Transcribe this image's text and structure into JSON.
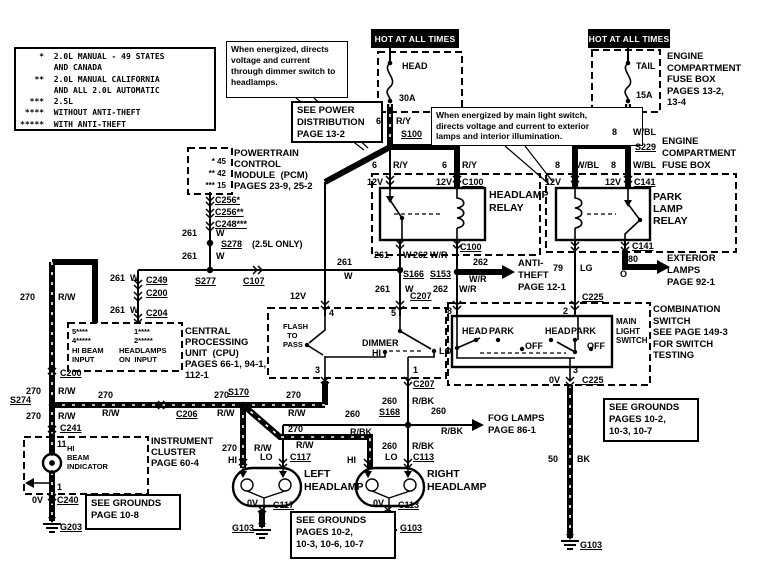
{
  "diagram": {
    "width": 775,
    "height": 571,
    "ink": "#000000",
    "paper": "#ffffff"
  },
  "bars": [
    {
      "name": "hot-at-all-times-left",
      "text": "HOT AT ALL TIMES",
      "x": 371,
      "y": 29,
      "w": 88,
      "h": 19
    },
    {
      "name": "hot-at-all-times-right",
      "text": "HOT AT ALL TIMES",
      "x": 588,
      "y": 29,
      "w": 82,
      "h": 19
    }
  ],
  "boxes": [
    {
      "name": "legend-box",
      "x": 14,
      "y": 47,
      "w": 202,
      "h": 84,
      "s": 8,
      "lh": 11.3,
      "mono": true,
      "lines": [
        "    *  2.0L MANUAL - 49 STATES",
        "       AND CANADA",
        "   **  2.0L MANUAL CALIFORNIA",
        "       AND ALL 2.0L AUTOMATIC",
        "  ***  2.5L",
        " ****  WITHOUT ANTI-THEFT",
        "*****  WITH ANTI-THEFT"
      ]
    },
    {
      "name": "note-dimmer",
      "x": 226,
      "y": 41,
      "w": 122,
      "h": 57,
      "s": 8.5,
      "lh": 11,
      "thin": true,
      "lines": [
        "When energized, directs",
        "voltage and current",
        "through dimmer switch to",
        "headlamps."
      ]
    },
    {
      "name": "see-power-distribution",
      "x": 291,
      "y": 101,
      "w": 92,
      "h": 42,
      "s": 9.5,
      "lh": 12,
      "lines": [
        "SEE POWER",
        "DISTRIBUTION",
        "PAGE 13-2"
      ]
    },
    {
      "name": "note-main-light-switch",
      "x": 431,
      "y": 107,
      "w": 212,
      "h": 39,
      "s": 8.5,
      "lh": 10.5,
      "thin": true,
      "lines": [
        "When energized by main light switch,",
        "directs voltage and current to exterior",
        "lamps and interior illumination."
      ]
    },
    {
      "name": "see-grounds-right",
      "x": 603,
      "y": 398,
      "w": 96,
      "h": 44,
      "s": 9.5,
      "lh": 12,
      "lines": [
        "SEE GROUNDS",
        "PAGES 10-2,",
        "10-3, 10-7"
      ]
    },
    {
      "name": "see-grounds-bottom",
      "x": 290,
      "y": 511,
      "w": 106,
      "h": 48,
      "s": 9.5,
      "lh": 12,
      "lines": [
        "SEE GROUNDS",
        "PAGES 10-2,",
        "10-3, 10-6, 10-7"
      ]
    },
    {
      "name": "see-grounds-cluster",
      "x": 85,
      "y": 494,
      "w": 96,
      "h": 36,
      "s": 9.5,
      "lh": 12,
      "lines": [
        "SEE GROUNDS",
        "PAGE 10-8"
      ]
    }
  ],
  "texts": [
    {
      "name": "engine-fusebox-top-label",
      "x": 667,
      "y": 51,
      "s": 9.5,
      "lh": 11.5,
      "lines": [
        "ENGINE",
        "COMPARTMENT",
        "FUSE BOX",
        "PAGES 13-2,",
        "13-4"
      ]
    },
    {
      "name": "engine-fusebox-mid-label",
      "x": 662,
      "y": 136,
      "s": 9.5,
      "lh": 12,
      "lines": [
        "ENGINE",
        "COMPARTMENT",
        "FUSE BOX"
      ]
    },
    {
      "name": "pcm-pins",
      "x": 192,
      "y": 156,
      "w": 34,
      "s": 8,
      "lh": 12,
      "align": "right",
      "lines": [
        "* 45",
        "** 42",
        "*** 15"
      ]
    },
    {
      "name": "pcm-label",
      "x": 234,
      "y": 148,
      "s": 9.5,
      "lh": 11,
      "lines": [
        "POWERTRAIN",
        "CONTROL",
        "MODULE  (PCM)",
        "PAGES 23-9, 25-2"
      ]
    },
    {
      "name": "headlamp-relay-label",
      "x": 489,
      "y": 189,
      "s": 10.5,
      "lh": 13,
      "lines": [
        "HEADLAMP",
        "RELAY"
      ]
    },
    {
      "name": "park-lamp-relay-label",
      "x": 653,
      "y": 191,
      "s": 10.5,
      "lh": 12,
      "lines": [
        "PARK",
        "LAMP",
        "RELAY"
      ]
    },
    {
      "name": "anti-theft-ref",
      "x": 518,
      "y": 258,
      "s": 9.5,
      "lh": 12,
      "lines": [
        "ANTI-",
        "THEFT",
        "PAGE 12-1"
      ]
    },
    {
      "name": "exterior-lamps-ref",
      "x": 667,
      "y": 253,
      "s": 9.5,
      "lh": 12,
      "lines": [
        "EXTERIOR",
        "LAMPS",
        "PAGE 92-1"
      ]
    },
    {
      "name": "cpu-pin-hibeam-nums",
      "x": 72,
      "y": 327,
      "s": 7.5,
      "lh": 9,
      "lines": [
        "5****",
        "4*****"
      ]
    },
    {
      "name": "cpu-pin-hibeam-label",
      "x": 72,
      "y": 346,
      "s": 7.5,
      "lh": 9,
      "lines": [
        "HI BEAM",
        "INPUT"
      ]
    },
    {
      "name": "cpu-pin-headlampson-nums",
      "x": 134,
      "y": 327,
      "s": 7.5,
      "lh": 9,
      "lines": [
        "1****",
        "2*****"
      ]
    },
    {
      "name": "cpu-pin-headlampson-label",
      "x": 119,
      "y": 346,
      "s": 7.5,
      "lh": 9,
      "lines": [
        "HEADLAMPS",
        "ON  INPUT"
      ]
    },
    {
      "name": "cpu-label",
      "x": 185,
      "y": 326,
      "s": 9.5,
      "lh": 11,
      "lines": [
        "CENTRAL",
        "PROCESSING",
        "UNIT  (CPU)",
        "PAGES 66-1, 94-1,",
        "112-1"
      ]
    },
    {
      "name": "instrument-cluster-label",
      "x": 151,
      "y": 436,
      "s": 9.5,
      "lh": 11,
      "lines": [
        "INSTRUMENT",
        "CLUSTER",
        "PAGE 60-4"
      ]
    },
    {
      "name": "hi-beam-indicator-label",
      "x": 67,
      "y": 444,
      "s": 7.5,
      "lh": 9,
      "lines": [
        "HI",
        "BEAM",
        "INDICATOR"
      ]
    },
    {
      "name": "flash-to-pass-label",
      "x": 283,
      "y": 322,
      "s": 7.5,
      "lh": 9,
      "lines": [
        "FLASH",
        "  TO",
        "PASS"
      ]
    },
    {
      "name": "main-light-switch-label",
      "x": 616,
      "y": 317,
      "s": 8,
      "lh": 9.5,
      "lines": [
        "MAIN",
        "LIGHT",
        "SWITCH"
      ]
    },
    {
      "name": "combination-switch-label",
      "x": 653,
      "y": 304,
      "s": 9.5,
      "lh": 11.5,
      "lines": [
        "COMBINATION",
        "SWITCH",
        "SEE PAGE 149-3",
        "FOR SWITCH",
        "TESTING"
      ]
    },
    {
      "name": "fog-lamps-ref",
      "x": 488,
      "y": 413,
      "s": 9.5,
      "lh": 12,
      "lines": [
        "FOG LAMPS",
        "PAGE 86-1"
      ]
    },
    {
      "name": "left-headlamp-label",
      "x": 304,
      "y": 468,
      "s": 10.5,
      "lh": 13,
      "lines": [
        "LEFT",
        "HEADLAMP"
      ]
    },
    {
      "name": "right-headlamp-label",
      "x": 427,
      "y": 468,
      "s": 10.5,
      "lh": 13,
      "lines": [
        "RIGHT",
        "HEADLAMP"
      ]
    }
  ],
  "labels": [
    {
      "t": "HEAD",
      "x": 402,
      "y": 62
    },
    {
      "t": "30A",
      "x": 399,
      "y": 94
    },
    {
      "t": "TAIL",
      "x": 636,
      "y": 62
    },
    {
      "t": "15A",
      "x": 636,
      "y": 91
    },
    {
      "t": "6",
      "x": 376,
      "y": 117
    },
    {
      "t": "R/Y",
      "x": 396,
      "y": 117
    },
    {
      "t": "S100",
      "x": 401,
      "y": 130,
      "u": 1
    },
    {
      "t": "8",
      "x": 612,
      "y": 128
    },
    {
      "t": "W/BL",
      "x": 633,
      "y": 128
    },
    {
      "t": "S229",
      "x": 635,
      "y": 143,
      "u": 1
    },
    {
      "t": "6",
      "x": 372,
      "y": 161
    },
    {
      "t": "R/Y",
      "x": 393,
      "y": 161
    },
    {
      "t": "6",
      "x": 442,
      "y": 161
    },
    {
      "t": "R/Y",
      "x": 462,
      "y": 161
    },
    {
      "t": "12V",
      "x": 367,
      "y": 178
    },
    {
      "t": "12V",
      "x": 436,
      "y": 178
    },
    {
      "t": "C100",
      "x": 462,
      "y": 178,
      "u": 1
    },
    {
      "t": "8",
      "x": 555,
      "y": 161
    },
    {
      "t": "W/BL",
      "x": 576,
      "y": 161
    },
    {
      "t": "8",
      "x": 611,
      "y": 161
    },
    {
      "t": "W/BL",
      "x": 633,
      "y": 161
    },
    {
      "t": "12V",
      "x": 545,
      "y": 178
    },
    {
      "t": "12V",
      "x": 605,
      "y": 178
    },
    {
      "t": "C141",
      "x": 634,
      "y": 178,
      "u": 1
    },
    {
      "t": "C100",
      "x": 460,
      "y": 243,
      "u": 1
    },
    {
      "t": "C141",
      "x": 632,
      "y": 242,
      "u": 1
    },
    {
      "t": "261",
      "x": 374,
      "y": 251
    },
    {
      "t": "W",
      "x": 403,
      "y": 251
    },
    {
      "t": "262",
      "x": 413,
      "y": 251
    },
    {
      "t": "W/R",
      "x": 430,
      "y": 251
    },
    {
      "t": "80",
      "x": 628,
      "y": 255
    },
    {
      "t": "O",
      "x": 620,
      "y": 270
    },
    {
      "t": "79",
      "x": 553,
      "y": 264
    },
    {
      "t": "LG",
      "x": 580,
      "y": 264
    },
    {
      "t": "261",
      "x": 337,
      "y": 258
    },
    {
      "t": "W",
      "x": 344,
      "y": 272
    },
    {
      "t": "S166",
      "x": 403,
      "y": 270,
      "u": 1
    },
    {
      "t": "S153",
      "x": 430,
      "y": 270,
      "u": 1
    },
    {
      "t": "262",
      "x": 473,
      "y": 258
    },
    {
      "t": "W/R",
      "x": 469,
      "y": 275
    },
    {
      "t": "C256*",
      "x": 215,
      "y": 196,
      "u": 1
    },
    {
      "t": "C256**",
      "x": 215,
      "y": 208,
      "u": 1
    },
    {
      "t": "C248***",
      "x": 215,
      "y": 220,
      "u": 1
    },
    {
      "t": "261",
      "x": 182,
      "y": 229
    },
    {
      "t": "W",
      "x": 216,
      "y": 229
    },
    {
      "t": "S278",
      "x": 221,
      "y": 240,
      "u": 1
    },
    {
      "t": "(2.5L ONLY)",
      "x": 252,
      "y": 240
    },
    {
      "t": "261",
      "x": 182,
      "y": 252
    },
    {
      "t": "W",
      "x": 216,
      "y": 252
    },
    {
      "t": "261",
      "x": 110,
      "y": 274
    },
    {
      "t": "W",
      "x": 130,
      "y": 274
    },
    {
      "t": "C249",
      "x": 146,
      "y": 276,
      "u": 1
    },
    {
      "t": "C200",
      "x": 146,
      "y": 289,
      "u": 1
    },
    {
      "t": "261",
      "x": 110,
      "y": 306
    },
    {
      "t": "W",
      "x": 130,
      "y": 306
    },
    {
      "t": "C204",
      "x": 146,
      "y": 309,
      "u": 1
    },
    {
      "t": "S277",
      "x": 195,
      "y": 277,
      "u": 1
    },
    {
      "t": "C107",
      "x": 243,
      "y": 277,
      "u": 1
    },
    {
      "t": "270",
      "x": 20,
      "y": 293
    },
    {
      "t": "R/W",
      "x": 58,
      "y": 293
    },
    {
      "t": "C200",
      "x": 60,
      "y": 369,
      "u": 1
    },
    {
      "t": "270",
      "x": 26,
      "y": 387
    },
    {
      "t": "R/W",
      "x": 58,
      "y": 387
    },
    {
      "t": "S274",
      "x": 10,
      "y": 396,
      "u": 1
    },
    {
      "t": "270",
      "x": 26,
      "y": 412
    },
    {
      "t": "R/W",
      "x": 58,
      "y": 412
    },
    {
      "t": "C241",
      "x": 60,
      "y": 424,
      "u": 1
    },
    {
      "t": "11",
      "x": 57,
      "y": 440
    },
    {
      "t": "1",
      "x": 57,
      "y": 483
    },
    {
      "t": "0V",
      "x": 32,
      "y": 496
    },
    {
      "t": "C240",
      "x": 57,
      "y": 496,
      "u": 1
    },
    {
      "t": "G203",
      "x": 60,
      "y": 523,
      "u": 1
    },
    {
      "t": "270",
      "x": 98,
      "y": 391
    },
    {
      "t": "R/W",
      "x": 102,
      "y": 409
    },
    {
      "t": "C206",
      "x": 176,
      "y": 410,
      "u": 1
    },
    {
      "t": "270",
      "x": 214,
      "y": 391
    },
    {
      "t": "R/W",
      "x": 217,
      "y": 409
    },
    {
      "t": "S170",
      "x": 228,
      "y": 388,
      "u": 1
    },
    {
      "t": "270",
      "x": 286,
      "y": 391
    },
    {
      "t": "R/W",
      "x": 288,
      "y": 409
    },
    {
      "t": "12V",
      "x": 290,
      "y": 292
    },
    {
      "t": "261",
      "x": 375,
      "y": 285
    },
    {
      "t": "W",
      "x": 405,
      "y": 285
    },
    {
      "t": "C207",
      "x": 410,
      "y": 292,
      "u": 1
    },
    {
      "t": "262",
      "x": 433,
      "y": 285
    },
    {
      "t": "W/R",
      "x": 459,
      "y": 285
    },
    {
      "t": "4",
      "x": 329,
      "y": 309
    },
    {
      "t": "5",
      "x": 391,
      "y": 309
    },
    {
      "t": "3",
      "x": 315,
      "y": 366
    },
    {
      "t": "1",
      "x": 413,
      "y": 366
    },
    {
      "t": "C207",
      "x": 413,
      "y": 380,
      "u": 1
    },
    {
      "t": "DIMMER",
      "x": 362,
      "y": 339
    },
    {
      "t": "HI",
      "x": 372,
      "y": 349
    },
    {
      "t": "LO",
      "x": 439,
      "y": 347
    },
    {
      "t": "8",
      "x": 447,
      "y": 307
    },
    {
      "t": "2",
      "x": 563,
      "y": 307
    },
    {
      "t": "3",
      "x": 573,
      "y": 366
    },
    {
      "t": "HEAD",
      "x": 462,
      "y": 327
    },
    {
      "t": "PARK",
      "x": 489,
      "y": 327
    },
    {
      "t": "OFF",
      "x": 525,
      "y": 342
    },
    {
      "t": "HEAD",
      "x": 545,
      "y": 327
    },
    {
      "t": "PARK",
      "x": 571,
      "y": 327
    },
    {
      "t": "OFF",
      "x": 587,
      "y": 342
    },
    {
      "t": "C225",
      "x": 582,
      "y": 293,
      "u": 1
    },
    {
      "t": "0V",
      "x": 549,
      "y": 376
    },
    {
      "t": "C225",
      "x": 582,
      "y": 376,
      "u": 1
    },
    {
      "t": "260",
      "x": 382,
      "y": 397
    },
    {
      "t": "R/BK",
      "x": 412,
      "y": 397
    },
    {
      "t": "260",
      "x": 345,
      "y": 410
    },
    {
      "t": "S168",
      "x": 379,
      "y": 408,
      "u": 1
    },
    {
      "t": "R/BK",
      "x": 350,
      "y": 428
    },
    {
      "t": "260",
      "x": 431,
      "y": 407
    },
    {
      "t": "R/BK",
      "x": 441,
      "y": 427
    },
    {
      "t": "260",
      "x": 382,
      "y": 442
    },
    {
      "t": "R/BK",
      "x": 412,
      "y": 442
    },
    {
      "t": "270",
      "x": 288,
      "y": 425
    },
    {
      "t": "R/W",
      "x": 296,
      "y": 441
    },
    {
      "t": "270",
      "x": 222,
      "y": 444
    },
    {
      "t": "R/W",
      "x": 254,
      "y": 444
    },
    {
      "t": "HI",
      "x": 228,
      "y": 456
    },
    {
      "t": "LO",
      "x": 260,
      "y": 453
    },
    {
      "t": "C117",
      "x": 290,
      "y": 453,
      "u": 1
    },
    {
      "t": "HI",
      "x": 347,
      "y": 456
    },
    {
      "t": "LO",
      "x": 385,
      "y": 453
    },
    {
      "t": "C113",
      "x": 413,
      "y": 453,
      "u": 1
    },
    {
      "t": "0V",
      "x": 247,
      "y": 499
    },
    {
      "t": "C117",
      "x": 273,
      "y": 501,
      "u": 1
    },
    {
      "t": "0V",
      "x": 373,
      "y": 499
    },
    {
      "t": "C113",
      "x": 398,
      "y": 501,
      "u": 1
    },
    {
      "t": "G103",
      "x": 232,
      "y": 524,
      "u": 1
    },
    {
      "t": "G103",
      "x": 400,
      "y": 524,
      "u": 1
    },
    {
      "t": "50",
      "x": 548,
      "y": 455
    },
    {
      "t": "BK",
      "x": 577,
      "y": 455
    },
    {
      "t": "G103",
      "x": 580,
      "y": 541,
      "u": 1
    }
  ]
}
